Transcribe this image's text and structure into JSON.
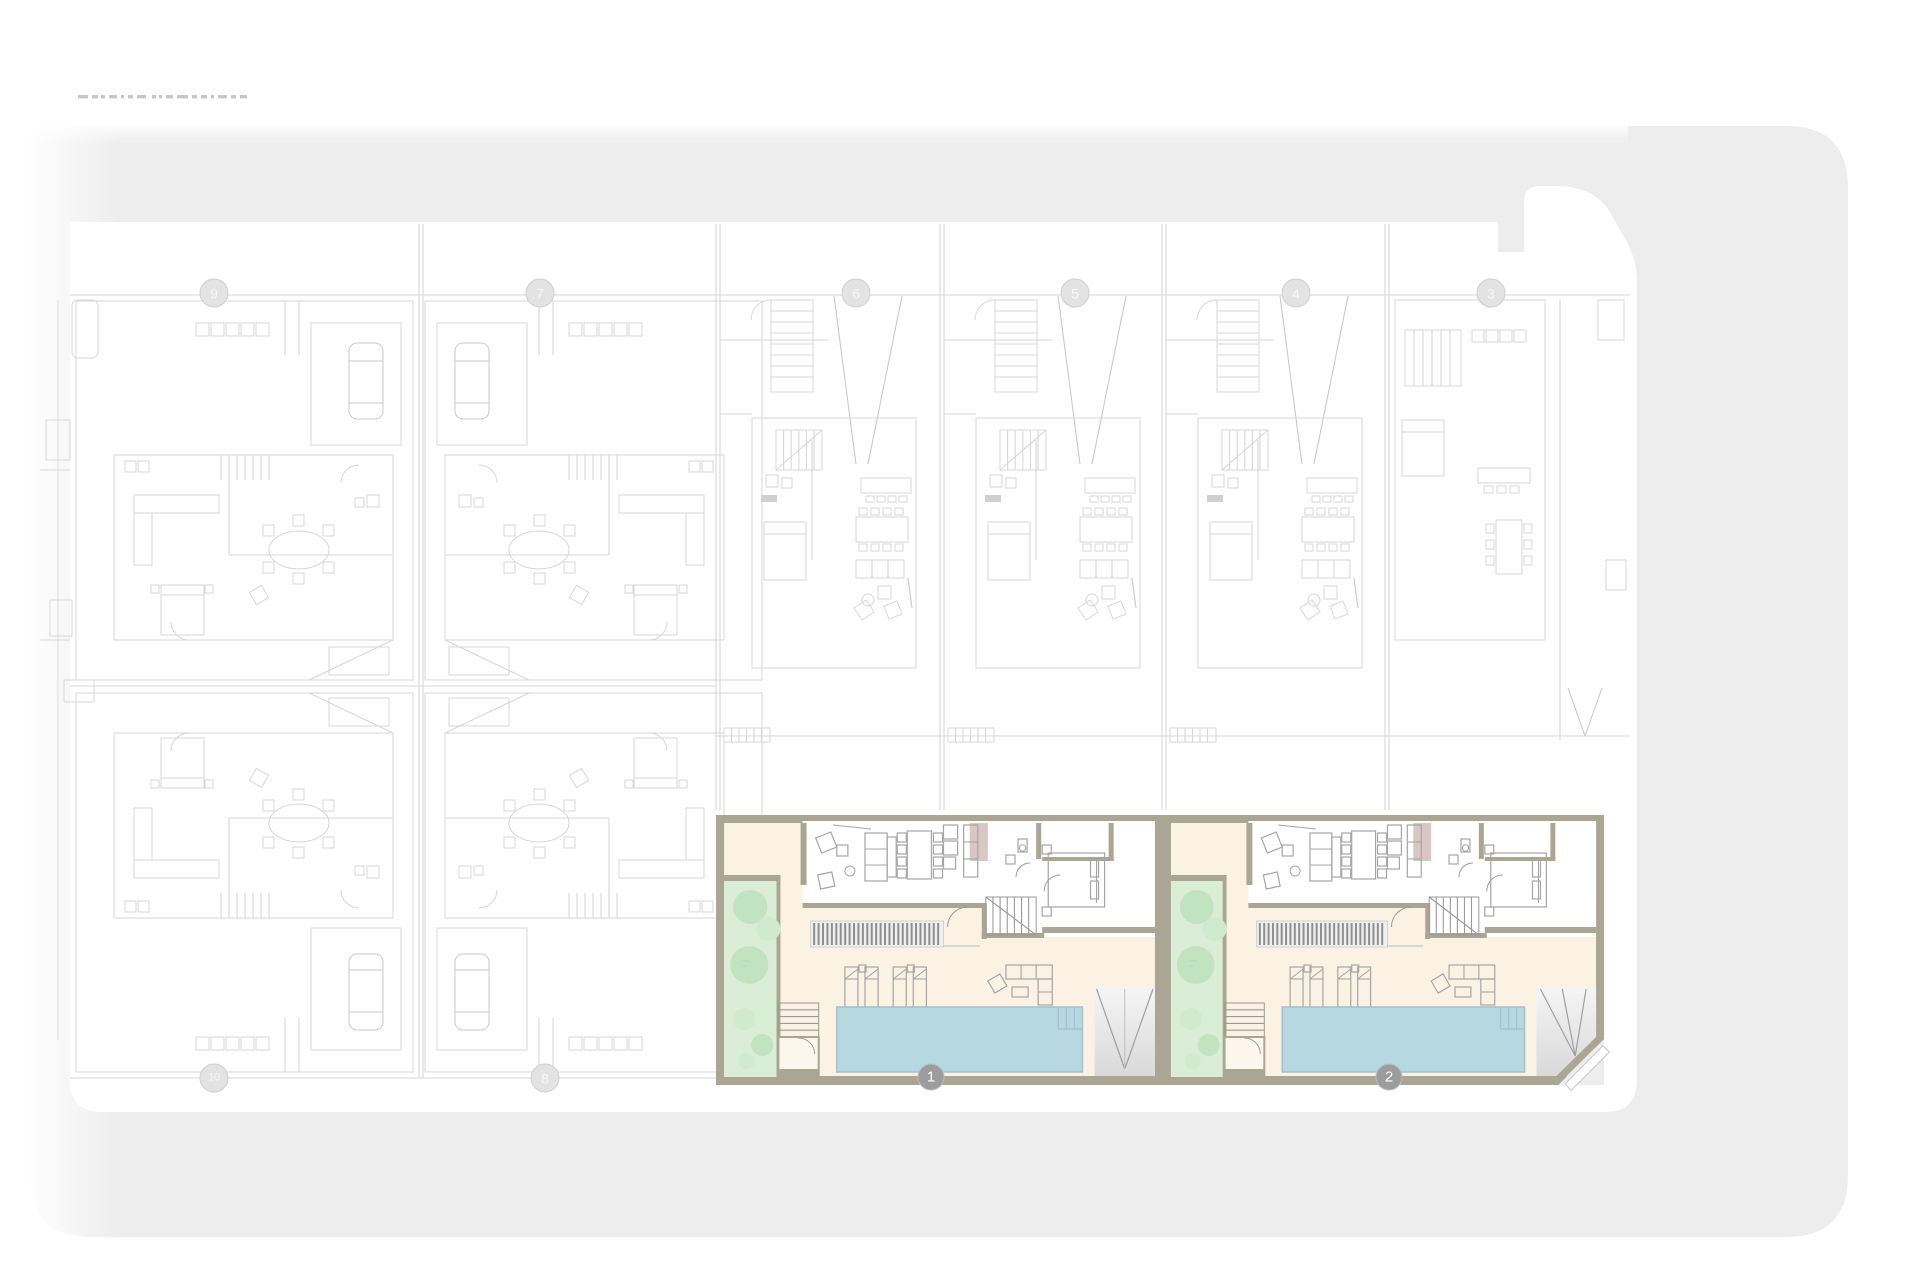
{
  "plan": {
    "kind": "residential site floor plan",
    "highlighted_unit_count": 2
  },
  "grid_bubbles": {
    "top": [
      {
        "label": "9",
        "x": 214,
        "y": 293
      },
      {
        "label": "7",
        "x": 540,
        "y": 293
      },
      {
        "label": "6",
        "x": 856,
        "y": 293
      },
      {
        "label": "5",
        "x": 1075,
        "y": 293
      },
      {
        "label": "4",
        "x": 1296,
        "y": 293
      },
      {
        "label": "3",
        "x": 1491,
        "y": 293
      }
    ],
    "bottom": [
      {
        "label": "10",
        "x": 214,
        "y": 1078
      },
      {
        "label": "8",
        "x": 545,
        "y": 1078
      }
    ]
  },
  "units": [
    {
      "label": "1",
      "x": 716,
      "y": 815,
      "width": 447,
      "height": 270,
      "bubble": {
        "x": 931,
        "y": 1077
      },
      "driveway": "straight"
    },
    {
      "label": "2",
      "x": 1163,
      "y": 815,
      "width": 441,
      "height": 270,
      "bubble": {
        "x": 1389,
        "y": 1077
      },
      "driveway": "chamfered"
    }
  ],
  "colors": {
    "page_bg": "#ffffff",
    "street": "#ededee",
    "plot": "#ffffff",
    "faint_line": "#d7d7d7",
    "faint_line_dark": "#c9c9c9",
    "wall": "#aba593",
    "floor": "#fbf2e4",
    "interior": "#ffffff",
    "garden": "#d9edd7",
    "tree_a": "#c2e3c0",
    "tree_b": "#cfeacd",
    "pool": "#b6d8e1",
    "pool_edge": "#9fc2cd",
    "accent_pink": "#d9c7c3",
    "furniture_line": "#a5a5a5",
    "pergola_stripe": "#8f8f8f",
    "bubble_active": "#9c9c9c",
    "bubble_inactive_fill": "#e3e3e3",
    "bubble_inactive_stroke": "#cfcfcf",
    "bubble_text": "#ffffff",
    "drive_light": "#f5f5f5",
    "drive_dark": "#d9d9d9"
  }
}
